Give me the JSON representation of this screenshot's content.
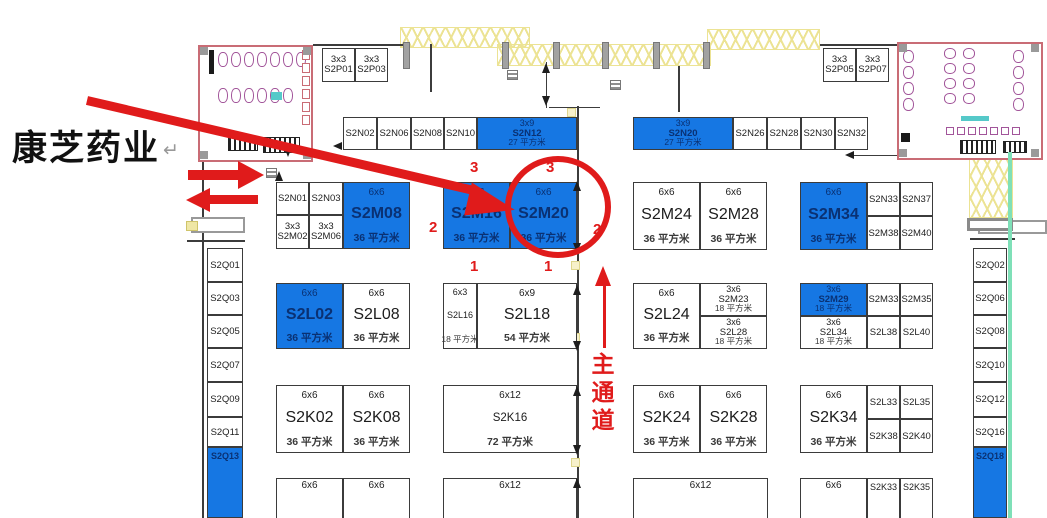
{
  "annotation": {
    "company": "康芝药业",
    "return_mark": "↵"
  },
  "aisle": {
    "label": "主通道",
    "chars": [
      "主",
      "通",
      "道"
    ]
  },
  "colors": {
    "accent_red": "#e01b1b",
    "booth_blue": "#1677e3",
    "booth_blue_text": "#0a3173",
    "line_black": "#3b3b3b",
    "truss_yellow": "#ece394",
    "restroom_pink": "#c96c75",
    "fixture_purple": "#a2559a",
    "teal": "#55c9c9",
    "green_wall": "#7fe0b8"
  },
  "red_markers": [
    {
      "text": "3",
      "x": 470,
      "y": 159
    },
    {
      "text": "3",
      "x": 546,
      "y": 159
    },
    {
      "text": "2",
      "x": 429,
      "y": 219
    },
    {
      "text": "2",
      "x": 593,
      "y": 221
    },
    {
      "text": "1",
      "x": 470,
      "y": 258
    },
    {
      "text": "1",
      "x": 544,
      "y": 258
    }
  ],
  "booths": [
    {
      "id": "S2P01",
      "size": "3x3",
      "x": 322,
      "y": 48,
      "w": 33,
      "h": 34
    },
    {
      "id": "S2P03",
      "size": "3x3",
      "x": 355,
      "y": 48,
      "w": 33,
      "h": 34
    },
    {
      "id": "S2P05",
      "size": "3x3",
      "x": 823,
      "y": 48,
      "w": 33,
      "h": 34
    },
    {
      "id": "S2P07",
      "size": "3x3",
      "x": 856,
      "y": 48,
      "w": 33,
      "h": 34
    },
    {
      "id": "S2N02",
      "x": 343,
      "y": 117,
      "w": 34,
      "h": 33
    },
    {
      "id": "S2N06",
      "x": 377,
      "y": 117,
      "w": 34,
      "h": 33
    },
    {
      "id": "S2N08",
      "x": 411,
      "y": 117,
      "w": 33,
      "h": 33
    },
    {
      "id": "S2N10",
      "x": 444,
      "y": 117,
      "w": 33,
      "h": 33
    },
    {
      "id": "S2N12",
      "size": "3x9",
      "area": "27 平方米",
      "variant": "blue",
      "x": 477,
      "y": 117,
      "w": 100,
      "h": 33
    },
    {
      "id": "S2N20",
      "size": "3x9",
      "area": "27 平方米",
      "variant": "blue",
      "x": 633,
      "y": 117,
      "w": 100,
      "h": 33
    },
    {
      "id": "S2N26",
      "x": 733,
      "y": 117,
      "w": 34,
      "h": 33
    },
    {
      "id": "S2N28",
      "x": 767,
      "y": 117,
      "w": 34,
      "h": 33
    },
    {
      "id": "S2N30",
      "x": 801,
      "y": 117,
      "w": 34,
      "h": 33
    },
    {
      "id": "S2N32",
      "x": 835,
      "y": 117,
      "w": 33,
      "h": 33
    },
    {
      "id": "S2N01",
      "x": 276,
      "y": 182,
      "w": 33,
      "h": 33
    },
    {
      "id": "S2N03",
      "x": 309,
      "y": 182,
      "w": 34,
      "h": 33
    },
    {
      "id": "S2M02",
      "size": "3x3",
      "x": 276,
      "y": 215,
      "w": 33,
      "h": 34
    },
    {
      "id": "S2M06",
      "size": "3x3",
      "x": 309,
      "y": 215,
      "w": 34,
      "h": 34
    },
    {
      "id": "S2M08",
      "size": "6x6",
      "area": "36 平方米",
      "variant": "blue",
      "x": 343,
      "y": 182,
      "w": 67,
      "h": 67
    },
    {
      "id": "S2M16",
      "size": "6x6",
      "area": "36 平方米",
      "variant": "blue",
      "x": 443,
      "y": 182,
      "w": 67,
      "h": 67
    },
    {
      "id": "S2M20",
      "size": "6x6",
      "area": "36 平方米",
      "variant": "blue",
      "x": 510,
      "y": 182,
      "w": 67,
      "h": 67,
      "highlighted": true
    },
    {
      "id": "S2M24",
      "size": "6x6",
      "area": "36 平方米",
      "x": 633,
      "y": 182,
      "w": 67,
      "h": 68
    },
    {
      "id": "S2M28",
      "size": "6x6",
      "area": "36 平方米",
      "x": 700,
      "y": 182,
      "w": 67,
      "h": 68
    },
    {
      "id": "S2M34",
      "size": "6x6",
      "area": "36 平方米",
      "variant": "blue",
      "x": 800,
      "y": 182,
      "w": 67,
      "h": 68
    },
    {
      "id": "S2N33",
      "x": 867,
      "y": 182,
      "w": 33,
      "h": 34
    },
    {
      "id": "S2N37",
      "x": 900,
      "y": 182,
      "w": 33,
      "h": 34
    },
    {
      "id": "S2M38",
      "x": 867,
      "y": 216,
      "w": 33,
      "h": 34
    },
    {
      "id": "S2M40",
      "x": 900,
      "y": 216,
      "w": 33,
      "h": 34
    },
    {
      "id": "S2L02",
      "size": "6x6",
      "area": "36 平方米",
      "variant": "blue",
      "x": 276,
      "y": 283,
      "w": 67,
      "h": 66
    },
    {
      "id": "S2L08",
      "size": "6x6",
      "area": "36 平方米",
      "x": 343,
      "y": 283,
      "w": 67,
      "h": 66
    },
    {
      "id": "S2L16",
      "size": "6x3",
      "area": "18 平方米",
      "x": 443,
      "y": 283,
      "w": 34,
      "h": 66
    },
    {
      "id": "S2L18",
      "size": "6x9",
      "area": "54 平方米",
      "x": 477,
      "y": 283,
      "w": 100,
      "h": 66
    },
    {
      "id": "S2L24",
      "size": "6x6",
      "area": "36 平方米",
      "x": 633,
      "y": 283,
      "w": 67,
      "h": 66
    },
    {
      "id": "S2M23",
      "size": "3x6",
      "area": "18 平方米",
      "x": 700,
      "y": 283,
      "w": 67,
      "h": 33
    },
    {
      "id": "S2L28",
      "size": "3x6",
      "area": "18 平方米",
      "x": 700,
      "y": 316,
      "w": 67,
      "h": 33
    },
    {
      "id": "S2M29",
      "size": "3x6",
      "area": "18 平方米",
      "variant": "blue",
      "x": 800,
      "y": 283,
      "w": 67,
      "h": 33
    },
    {
      "id": "S2M33",
      "x": 867,
      "y": 283,
      "w": 33,
      "h": 33
    },
    {
      "id": "S2M35",
      "x": 900,
      "y": 283,
      "w": 33,
      "h": 33
    },
    {
      "id": "S2L34",
      "size": "3x6",
      "area": "18 平方米",
      "x": 800,
      "y": 316,
      "w": 67,
      "h": 33
    },
    {
      "id": "S2L38",
      "x": 867,
      "y": 316,
      "w": 33,
      "h": 33
    },
    {
      "id": "S2L40",
      "x": 900,
      "y": 316,
      "w": 33,
      "h": 33
    },
    {
      "id": "S2K02",
      "size": "6x6",
      "area": "36 平方米",
      "x": 276,
      "y": 385,
      "w": 67,
      "h": 68
    },
    {
      "id": "S2K08",
      "size": "6x6",
      "area": "36 平方米",
      "x": 343,
      "y": 385,
      "w": 67,
      "h": 68
    },
    {
      "id": "S2K16",
      "size": "6x12",
      "area": "72 平方米",
      "x": 443,
      "y": 385,
      "w": 134,
      "h": 68
    },
    {
      "id": "S2K24",
      "size": "6x6",
      "area": "36 平方米",
      "x": 633,
      "y": 385,
      "w": 67,
      "h": 68
    },
    {
      "id": "S2K28",
      "size": "6x6",
      "area": "36 平方米",
      "x": 700,
      "y": 385,
      "w": 67,
      "h": 68
    },
    {
      "id": "S2K34",
      "size": "6x6",
      "area": "36 平方米",
      "x": 800,
      "y": 385,
      "w": 67,
      "h": 68
    },
    {
      "id": "S2L33",
      "x": 867,
      "y": 385,
      "w": 33,
      "h": 34
    },
    {
      "id": "S2L35",
      "x": 900,
      "y": 385,
      "w": 33,
      "h": 34
    },
    {
      "id": "S2K38",
      "x": 867,
      "y": 419,
      "w": 33,
      "h": 34
    },
    {
      "id": "S2K40",
      "x": 900,
      "y": 419,
      "w": 33,
      "h": 34
    },
    {
      "size": "6x6",
      "x": 276,
      "y": 478,
      "w": 67,
      "h": 45
    },
    {
      "size": "6x6",
      "x": 343,
      "y": 478,
      "w": 67,
      "h": 45
    },
    {
      "size": "6x12",
      "x": 443,
      "y": 478,
      "w": 134,
      "h": 45
    },
    {
      "size": "6x12",
      "x": 633,
      "y": 478,
      "w": 135,
      "h": 45
    },
    {
      "size": "6x6",
      "x": 800,
      "y": 478,
      "w": 67,
      "h": 45
    },
    {
      "id": "S2K33",
      "x": 867,
      "y": 478,
      "w": 33,
      "h": 45
    },
    {
      "id": "S2K35",
      "x": 900,
      "y": 478,
      "w": 33,
      "h": 45
    },
    {
      "id": "S2Q01",
      "x": 207,
      "y": 248,
      "w": 36,
      "h": 34
    },
    {
      "id": "S2Q03",
      "x": 207,
      "y": 282,
      "w": 36,
      "h": 33
    },
    {
      "id": "S2Q05",
      "x": 207,
      "y": 315,
      "w": 36,
      "h": 33
    },
    {
      "id": "S2Q07",
      "x": 207,
      "y": 348,
      "w": 36,
      "h": 34
    },
    {
      "id": "S2Q09",
      "x": 207,
      "y": 382,
      "w": 36,
      "h": 35
    },
    {
      "id": "S2Q11",
      "x": 207,
      "y": 417,
      "w": 36,
      "h": 30
    },
    {
      "id": "S2Q13",
      "variant": "blue",
      "x": 207,
      "y": 447,
      "w": 36,
      "h": 71
    },
    {
      "id": "S2Q02",
      "x": 973,
      "y": 248,
      "w": 34,
      "h": 34
    },
    {
      "id": "S2Q06",
      "x": 973,
      "y": 282,
      "w": 34,
      "h": 33
    },
    {
      "id": "S2Q08",
      "x": 973,
      "y": 315,
      "w": 34,
      "h": 33
    },
    {
      "id": "S2Q10",
      "x": 973,
      "y": 348,
      "w": 34,
      "h": 34
    },
    {
      "id": "S2Q12",
      "x": 973,
      "y": 382,
      "w": 34,
      "h": 35
    },
    {
      "id": "S2Q16",
      "x": 973,
      "y": 417,
      "w": 34,
      "h": 30
    },
    {
      "id": "S2Q18",
      "variant": "blue",
      "x": 973,
      "y": 447,
      "w": 34,
      "h": 71
    }
  ],
  "structures": {
    "walls": [
      [
        313,
        44,
        90,
        1.5
      ],
      [
        820,
        44,
        77,
        1.5
      ],
      [
        430,
        44,
        1.5,
        48
      ],
      [
        678,
        66,
        1.5,
        46
      ],
      [
        202,
        160,
        1.5,
        358
      ],
      [
        187,
        240,
        58,
        1.5
      ],
      [
        970,
        238,
        45,
        1.5
      ],
      [
        854,
        155,
        43,
        1.3
      ],
      [
        549,
        107,
        51,
        1.3
      ],
      [
        289,
        127,
        1.3,
        24
      ],
      [
        546,
        62,
        1.3,
        46
      ],
      [
        577,
        106,
        1.7,
        412
      ]
    ],
    "tris": [
      {
        "x": 572.5,
        "y": 181,
        "d": "u"
      },
      {
        "x": 572.5,
        "y": 243,
        "d": "d"
      },
      {
        "x": 572.5,
        "y": 285,
        "d": "u"
      },
      {
        "x": 572.5,
        "y": 341,
        "d": "d"
      },
      {
        "x": 572.5,
        "y": 386,
        "d": "u"
      },
      {
        "x": 572.5,
        "y": 445,
        "d": "d"
      },
      {
        "x": 572.5,
        "y": 478,
        "d": "u"
      },
      {
        "x": 542,
        "y": 63,
        "d": "u"
      },
      {
        "x": 542,
        "y": 96,
        "d": "d"
      },
      {
        "x": 333,
        "y": 142,
        "d": "l"
      },
      {
        "x": 845,
        "y": 151,
        "d": "l"
      },
      {
        "x": 284,
        "y": 147,
        "d": "d"
      },
      {
        "x": 274.5,
        "y": 171,
        "d": "u"
      }
    ],
    "dots": [
      [
        567,
        108
      ],
      [
        571,
        261
      ],
      [
        571,
        333
      ],
      [
        571,
        458
      ]
    ],
    "trusses": [
      [
        400,
        27,
        130,
        21
      ],
      [
        497,
        44,
        214,
        22
      ],
      [
        707,
        29,
        113,
        21
      ],
      [
        969,
        156,
        44,
        62
      ]
    ],
    "pillars": [
      403,
      502,
      553,
      602,
      653,
      703
    ],
    "pillar_y": 42,
    "hatch_squares": [
      [
        266,
        168
      ],
      [
        507,
        70
      ],
      [
        610,
        80
      ]
    ],
    "openings": [
      {
        "x": 191,
        "y": 217,
        "w": 54,
        "h": 16,
        "t": "thin"
      },
      {
        "x": 978,
        "y": 220,
        "w": 69,
        "h": 14,
        "t": "thin"
      },
      {
        "x": 967,
        "y": 218,
        "w": 46,
        "h": 13,
        "t": "thick"
      },
      {
        "x": 186,
        "y": 221,
        "w": 12,
        "h": 10,
        "t": "yellow"
      }
    ],
    "green_line": [
      1008,
      152,
      3.5,
      366
    ],
    "restrooms": [
      {
        "x": 198,
        "y": 45,
        "w": 115,
        "h": 117
      },
      {
        "x": 897,
        "y": 42,
        "w": 146,
        "h": 118
      }
    ],
    "fixtures": [
      {
        "k": "bar",
        "x": 209,
        "y": 50,
        "w": 5,
        "h": 24
      },
      {
        "k": "fx",
        "x": 218,
        "y": 52,
        "w": 10,
        "h": 15,
        "n": 7,
        "dx": 13
      },
      {
        "k": "fx",
        "x": 218,
        "y": 88,
        "w": 10,
        "h": 15,
        "n": 6,
        "dx": 13
      },
      {
        "k": "pk",
        "x": 302,
        "y": 50,
        "w": 8,
        "h": 10,
        "n": 6,
        "dy": 13
      },
      {
        "k": "teal",
        "x": 271,
        "y": 92,
        "w": 11,
        "h": 8
      },
      {
        "k": "hb",
        "x": 228,
        "y": 137,
        "w": 30,
        "h": 14
      },
      {
        "k": "hb",
        "x": 263,
        "y": 137,
        "w": 37,
        "h": 16
      },
      {
        "k": "gs",
        "x": 200,
        "y": 47
      },
      {
        "k": "gs",
        "x": 303,
        "y": 47
      },
      {
        "k": "gs",
        "x": 200,
        "y": 151
      },
      {
        "k": "gs",
        "x": 303,
        "y": 151
      },
      {
        "k": "fx",
        "x": 903,
        "y": 50,
        "w": 11,
        "h": 13,
        "n": 4,
        "dy": 16
      },
      {
        "k": "fx",
        "x": 944,
        "y": 48,
        "w": 12,
        "h": 11,
        "n": 4,
        "dy": 15
      },
      {
        "k": "fx",
        "x": 963,
        "y": 48,
        "w": 12,
        "h": 11,
        "n": 4,
        "dy": 15
      },
      {
        "k": "fx",
        "x": 1013,
        "y": 50,
        "w": 11,
        "h": 13,
        "n": 4,
        "dy": 16
      },
      {
        "k": "teal",
        "x": 961,
        "y": 116,
        "w": 28,
        "h": 5
      },
      {
        "k": "sqp",
        "x": 946,
        "y": 127,
        "w": 8,
        "h": 8,
        "n": 7,
        "dx": 11
      },
      {
        "k": "hb",
        "x": 960,
        "y": 140,
        "w": 36,
        "h": 14
      },
      {
        "k": "hb",
        "x": 1003,
        "y": 141,
        "w": 24,
        "h": 12
      },
      {
        "k": "bar",
        "x": 901,
        "y": 133,
        "w": 9,
        "h": 9
      },
      {
        "k": "gs",
        "x": 899,
        "y": 44
      },
      {
        "k": "gs",
        "x": 1031,
        "y": 44
      },
      {
        "k": "gs",
        "x": 899,
        "y": 149
      },
      {
        "k": "gs",
        "x": 1031,
        "y": 149
      }
    ]
  }
}
